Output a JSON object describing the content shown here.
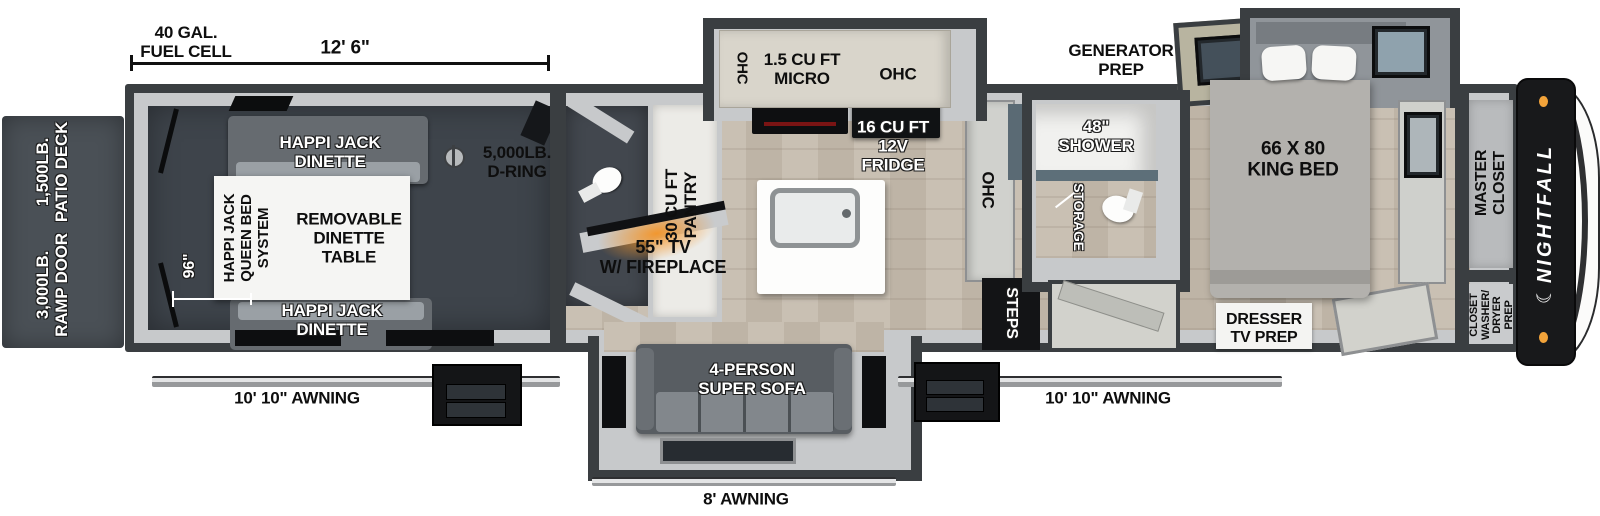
{
  "title": "Nightfall toy hauler floor plan",
  "colors": {
    "wall": "#3a3e41",
    "wall_lining": "#c7c9cb",
    "garage_floor": "#3e444b",
    "wood_floor": "#c4bbae",
    "patio_deck": "#4a5056",
    "cabinet_cream": "#d9d5cb",
    "sofa_gray": "#787d82",
    "bed_gray": "#b3b1ad",
    "marker_light": "#f2a33a",
    "fireplace_glow": "#f09030",
    "brand_band": "#18191b"
  },
  "exterior": {
    "patio_deck": "1,500LB.\nPATIO DECK",
    "ramp_door": "3,000LB.\nRAMP DOOR",
    "fuel_cell": "40 GAL.\nFUEL CELL",
    "garage_length": "12' 6\"",
    "generator": "GENERATOR\nPREP",
    "awning_left": "10' 10\" AWNING",
    "awning_right": "10' 10\" AWNING",
    "awning_rear": "8' AWNING"
  },
  "garage": {
    "dinette_top": "HAPPI JACK\nDINETTE",
    "dinette_bottom": "HAPPI JACK\nDINETTE",
    "d_ring": "5,000LB.\nD-RING",
    "queen_bed_system": "HAPPI JACK\nQUEEN BED\nSYSTEM",
    "dinette_table": "REMOVABLE\nDINETTE\nTABLE",
    "garage_width": "96\""
  },
  "kitchen": {
    "ohc_left": "OHC",
    "micro": "1.5 CU FT\nMICRO",
    "ohc_right": "OHC",
    "fridge": "16 CU FT\n12V\nFRIDGE",
    "pantry": "30 CU FT\nPANTRY",
    "ohc_wall": "OHC"
  },
  "living": {
    "tv_fireplace": "55\" TV\nW/ FIREPLACE",
    "sofa": "4-PERSON\nSUPER SOFA",
    "steps": "STEPS"
  },
  "bathroom": {
    "shower": "48\"\nSHOWER",
    "storage": "STORAGE"
  },
  "bedroom": {
    "king_bed": "66 X 80\nKING BED",
    "master_closet": "MASTER\nCLOSET",
    "dresser": "DRESSER\nTV PREP",
    "closet_washer_dryer": "CLOSET\nWASHER/\nDRYER\nPREP"
  },
  "brand": {
    "name": "NIGHTFALL",
    "crescent_icon": "☾"
  }
}
